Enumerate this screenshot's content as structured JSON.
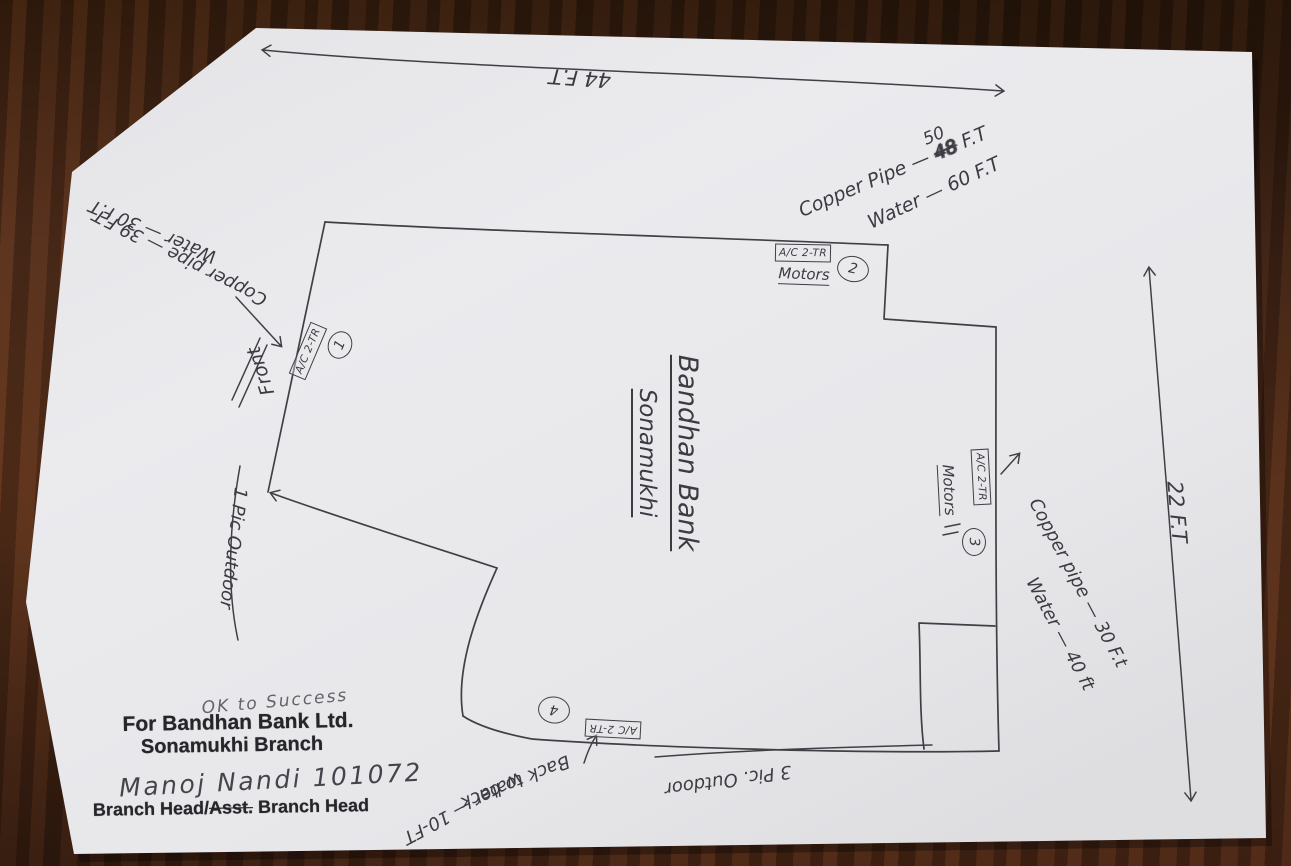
{
  "colors": {
    "ink": "#403f46",
    "stamp_ink": "#26252a",
    "paper": "#e9e9ec",
    "wood": "#58311f"
  },
  "dimensions": {
    "top": "44 F.T",
    "right": "22 F.T"
  },
  "pipes": {
    "top_right": {
      "label": "Copper Pipe —",
      "old_value": "48",
      "new_value": "50",
      "unit": "F.T",
      "water": "Water — 60 F.T"
    },
    "left": {
      "pipe": "Copper pipe — 39 F.T",
      "water": "Water — 30 F.T"
    },
    "right": {
      "pipe": "Copper pipe — 30 F.t",
      "water": "Water — 40 ft"
    }
  },
  "building": {
    "name_line1": "Bandhan Bank",
    "name_line2": "Sonamukhi",
    "front_label": "Front",
    "ac_label": "A/C 2-TR",
    "motors_label": "Motors",
    "unit_numbers": [
      "1",
      "2",
      "3",
      "4"
    ],
    "outdoor_left": "1 Pic Outdoor",
    "outdoor_bottom": "3 Pic. Outdoor",
    "back_to_back_line1": "Back to back",
    "back_to_back_line2": "water — 10-FT"
  },
  "stamp": {
    "approval": "OK to Success",
    "company": "For Bandhan Bank Ltd.",
    "branch": "Sonamukhi Branch",
    "signature": "Manoj Nandi 101072",
    "title_prefix": "Branch Head/",
    "title_struck": "Asst.",
    "title_suffix": " Branch Head"
  }
}
